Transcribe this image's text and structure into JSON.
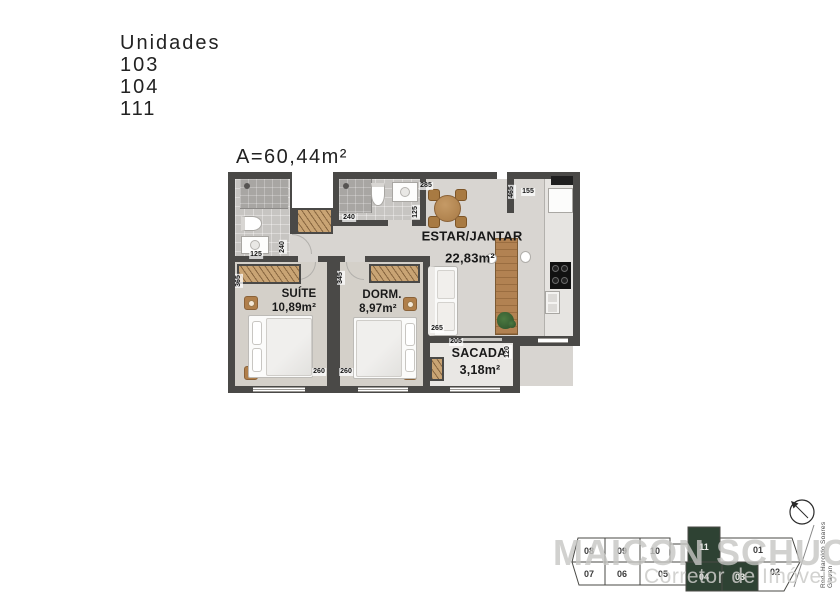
{
  "header": {
    "units_label": "Unidades",
    "units": [
      "103",
      "104",
      "111"
    ],
    "area": "A=60,44m²"
  },
  "plan": {
    "rooms": {
      "living": {
        "name": "ESTAR/JANTAR",
        "area": "22,83m²"
      },
      "suite": {
        "name": "SUÍTE",
        "area": "10,89m²"
      },
      "dorm": {
        "name": "DORM.",
        "area": "8,97m²"
      },
      "balcony": {
        "name": "SACADA",
        "area": "3,18m²"
      }
    },
    "dims": [
      {
        "v": "285"
      },
      {
        "v": "125"
      },
      {
        "v": "240"
      },
      {
        "v": "465"
      },
      {
        "v": "155"
      },
      {
        "v": "125"
      },
      {
        "v": "240"
      },
      {
        "v": "365"
      },
      {
        "v": "345"
      },
      {
        "v": "260"
      },
      {
        "v": "260"
      },
      {
        "v": "265"
      },
      {
        "v": "205"
      },
      {
        "v": "120"
      }
    ]
  },
  "keyplan": {
    "cells": [
      {
        "label": "08"
      },
      {
        "label": "09"
      },
      {
        "label": "10"
      },
      {
        "label": "11",
        "highlight": true
      },
      {
        "label": "01"
      },
      {
        "label": "07"
      },
      {
        "label": "06"
      },
      {
        "label": "05"
      },
      {
        "label": "04",
        "highlight": true
      },
      {
        "label": "03",
        "highlight": true
      },
      {
        "label": "02"
      }
    ],
    "highlight_color": "#2e4233",
    "street": "Rod. Haroldo Soares Glavan"
  },
  "watermark": {
    "line1": "MAICON SCHUCH",
    "line2": "Corretor de Imóveis"
  }
}
